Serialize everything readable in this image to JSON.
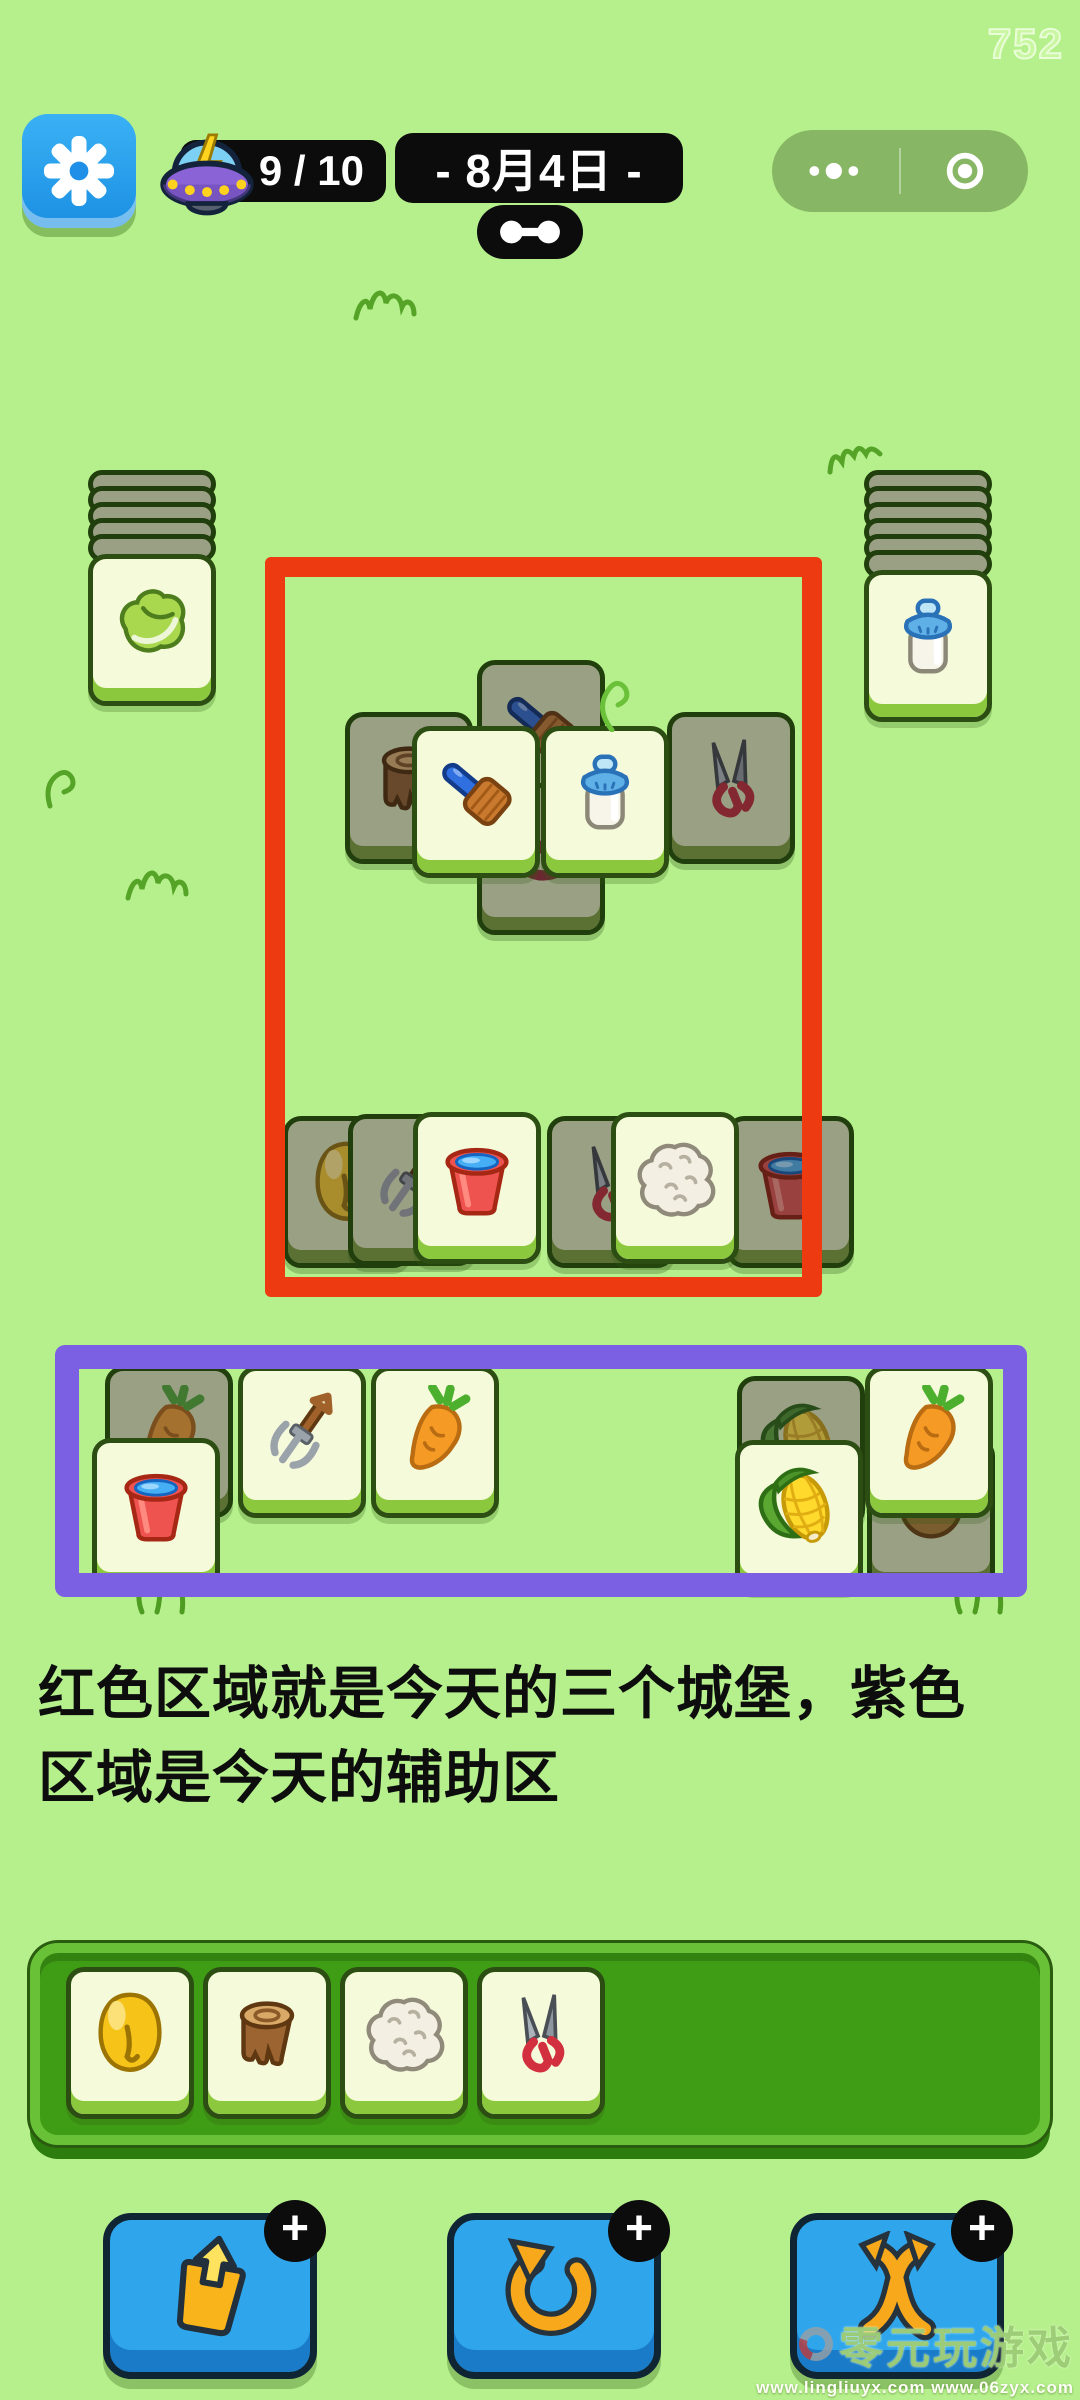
{
  "header": {
    "counter": "752",
    "energy_value": "9 / 10",
    "date_label": "- 8月4日 -"
  },
  "caption": {
    "line1": "红色区域就是今天的三个城堡，紫色",
    "line2": "区域是今天的辅助区"
  },
  "zones": {
    "red": {
      "x": 265,
      "y": 557,
      "w": 557,
      "h": 740,
      "color": "#ed3a10"
    },
    "purple": {
      "x": 55,
      "y": 1345,
      "w": 972,
      "h": 252,
      "color": "#7c60e4"
    }
  },
  "board": {
    "stacks": [
      {
        "icon": "cabbage",
        "x": 88,
        "y": 470,
        "bars": 5
      },
      {
        "icon": "milk",
        "x": 864,
        "y": 470,
        "bars": 6
      }
    ],
    "tiles": [
      {
        "icon": "brush",
        "x": 477,
        "y": 660,
        "variant": "covered",
        "z": 1
      },
      {
        "icon": "slingshot",
        "x": 477,
        "y": 783,
        "variant": "covered",
        "z": 1
      },
      {
        "icon": "stump",
        "x": 345,
        "y": 712,
        "variant": "covered",
        "z": 2
      },
      {
        "icon": "shears",
        "x": 667,
        "y": 712,
        "variant": "covered",
        "z": 2
      },
      {
        "icon": "brush",
        "x": 412,
        "y": 726,
        "variant": "open",
        "z": 3
      },
      {
        "icon": "milk",
        "x": 541,
        "y": 726,
        "variant": "open",
        "z": 3
      },
      {
        "icon": "bell",
        "x": 283,
        "y": 1116,
        "variant": "covered",
        "z": 1
      },
      {
        "icon": "pitchfork",
        "x": 348,
        "y": 1114,
        "variant": "covered",
        "z": 2
      },
      {
        "icon": "bucket",
        "x": 413,
        "y": 1112,
        "variant": "open",
        "z": 3
      },
      {
        "icon": "shears",
        "x": 547,
        "y": 1116,
        "variant": "covered",
        "z": 1
      },
      {
        "icon": "wool",
        "x": 611,
        "y": 1112,
        "variant": "open",
        "z": 3
      },
      {
        "icon": "bucket",
        "x": 726,
        "y": 1116,
        "variant": "covered",
        "z": 2
      },
      {
        "icon": "carrot",
        "x": 105,
        "y": 1366,
        "variant": "covered",
        "z": 1
      },
      {
        "icon": "bucket",
        "x": 92,
        "y": 1438,
        "variant": "open",
        "z": 2
      },
      {
        "icon": "pitchfork",
        "x": 238,
        "y": 1366,
        "variant": "open",
        "z": 1
      },
      {
        "icon": "carrot",
        "x": 371,
        "y": 1366,
        "variant": "open",
        "z": 1
      },
      {
        "icon": "corn",
        "x": 737,
        "y": 1376,
        "variant": "covered",
        "z": 1
      },
      {
        "icon": "corn",
        "x": 735,
        "y": 1440,
        "variant": "open",
        "z": 2
      },
      {
        "icon": "nut",
        "x": 867,
        "y": 1438,
        "variant": "covered",
        "z": 1
      },
      {
        "icon": "carrot",
        "x": 865,
        "y": 1366,
        "variant": "open",
        "z": 2
      }
    ]
  },
  "tray": {
    "tiles": [
      "bell",
      "stump",
      "wool",
      "shears"
    ]
  },
  "buttons": [
    {
      "icon": "popout",
      "badge": "+",
      "x": 103,
      "y": 2213
    },
    {
      "icon": "undo",
      "badge": "+",
      "x": 447,
      "y": 2213
    },
    {
      "icon": "shuffle",
      "badge": "+",
      "x": 790,
      "y": 2213
    }
  ],
  "watermark": {
    "brand": "零元玩游戏",
    "urls": "www.lingliuyx.com   www.06zyx.com"
  }
}
